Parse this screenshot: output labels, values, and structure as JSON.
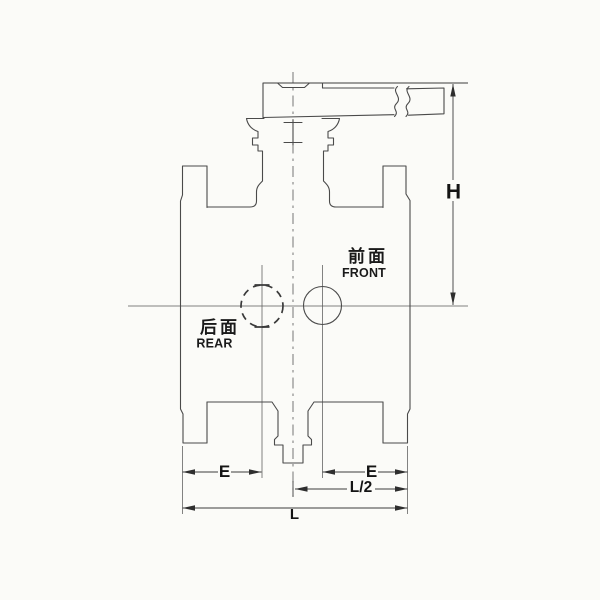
{
  "drawing": {
    "type": "valve-outline-technical-drawing",
    "labels": {
      "front_cn": "前面",
      "front_en": "FRONT",
      "rear_cn": "后面",
      "rear_en": "REAR"
    },
    "dimensions": {
      "height": "H",
      "end_left": "E",
      "end_right": "E",
      "half_length": "L/2",
      "length": "L"
    },
    "colors": {
      "background": "#fbfbf8",
      "outline": "#4a4a4a",
      "dimension": "#3c3c3c",
      "text": "#141414"
    }
  }
}
